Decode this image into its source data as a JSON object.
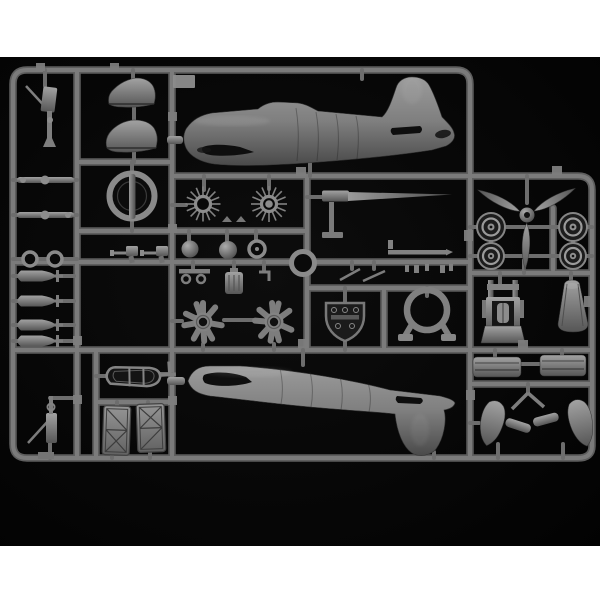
{
  "meta": {
    "description": "Product photograph of a gray injection-molded plastic model aircraft sprue on a black background, letterboxed with white bars top and bottom",
    "visible_text": "none (molded part numbers are illegible)"
  },
  "palette": {
    "page_bg": "#ffffff",
    "photo_bg": "#050505",
    "runner_gray": "#6d6d6d",
    "plastic_light": "#a2a2a2",
    "plastic_mid": "#7a7a7a",
    "plastic_dark": "#4f4f4f",
    "recess_dark": "#101010"
  },
  "photo": {
    "label": "Model kit sprue photograph"
  },
  "parts": [
    {
      "name": "sprue-frame",
      "label": "Sprue frame and runners"
    },
    {
      "name": "gun-part-top-left",
      "label": "Small gun part with diagonal barrel"
    },
    {
      "name": "strut-rods",
      "label": "Wing strut rods"
    },
    {
      "name": "small-rings",
      "label": "Two small ring parts"
    },
    {
      "name": "bombs",
      "label": "Four bombs with tail fins"
    },
    {
      "name": "gun-part-bottom-left",
      "label": "Machine gun part"
    },
    {
      "name": "cowling-halves",
      "label": "Engine cowling half shells"
    },
    {
      "name": "cowl-front-ring",
      "label": "Cowl front ring with bar"
    },
    {
      "name": "machine-guns",
      "label": "Two machine guns"
    },
    {
      "name": "pushrod-rings",
      "label": "Radial pushrod ring parts"
    },
    {
      "name": "intake-balls",
      "label": "Round intake parts"
    },
    {
      "name": "small-wheel",
      "label": "Small wheel ring"
    },
    {
      "name": "center-ring",
      "label": "Small cowl ring at runner junction"
    },
    {
      "name": "gun-barrel-rod",
      "label": "Long tapered gun barrel"
    },
    {
      "name": "control-rods",
      "label": "Control rods, levers and clamps"
    },
    {
      "name": "radial-engines",
      "label": "Two radial engine cylinder rows"
    },
    {
      "name": "engine-crankcase",
      "label": "Engine crankcase block"
    },
    {
      "name": "eyelet-bracket",
      "label": "Bracket with eyelets"
    },
    {
      "name": "instrument-panel",
      "label": "Instrument panel"
    },
    {
      "name": "engine-mount-ring",
      "label": "Engine mount ring with legs"
    },
    {
      "name": "bomb-rack",
      "label": "Boat-shaped rack fairing"
    },
    {
      "name": "bay-doors",
      "label": "Two hatch door panels"
    },
    {
      "name": "fuselage-upper",
      "label": "Fuselage half with tail fin up"
    },
    {
      "name": "fuselage-lower",
      "label": "Fuselage half with tail fin down"
    },
    {
      "name": "propeller",
      "label": "Three-blade propeller"
    },
    {
      "name": "main-wheels",
      "label": "Four main wheels"
    },
    {
      "name": "engine-block",
      "label": "Engine block assembly"
    },
    {
      "name": "nose-cowling",
      "label": "Tapered nose cowling"
    },
    {
      "name": "cowl-bands",
      "label": "Two cowl ring bands"
    },
    {
      "name": "wheel-spats",
      "label": "Wheel spats and gear struts"
    },
    {
      "name": "number-tags",
      "label": "Molded number tag plates"
    }
  ]
}
